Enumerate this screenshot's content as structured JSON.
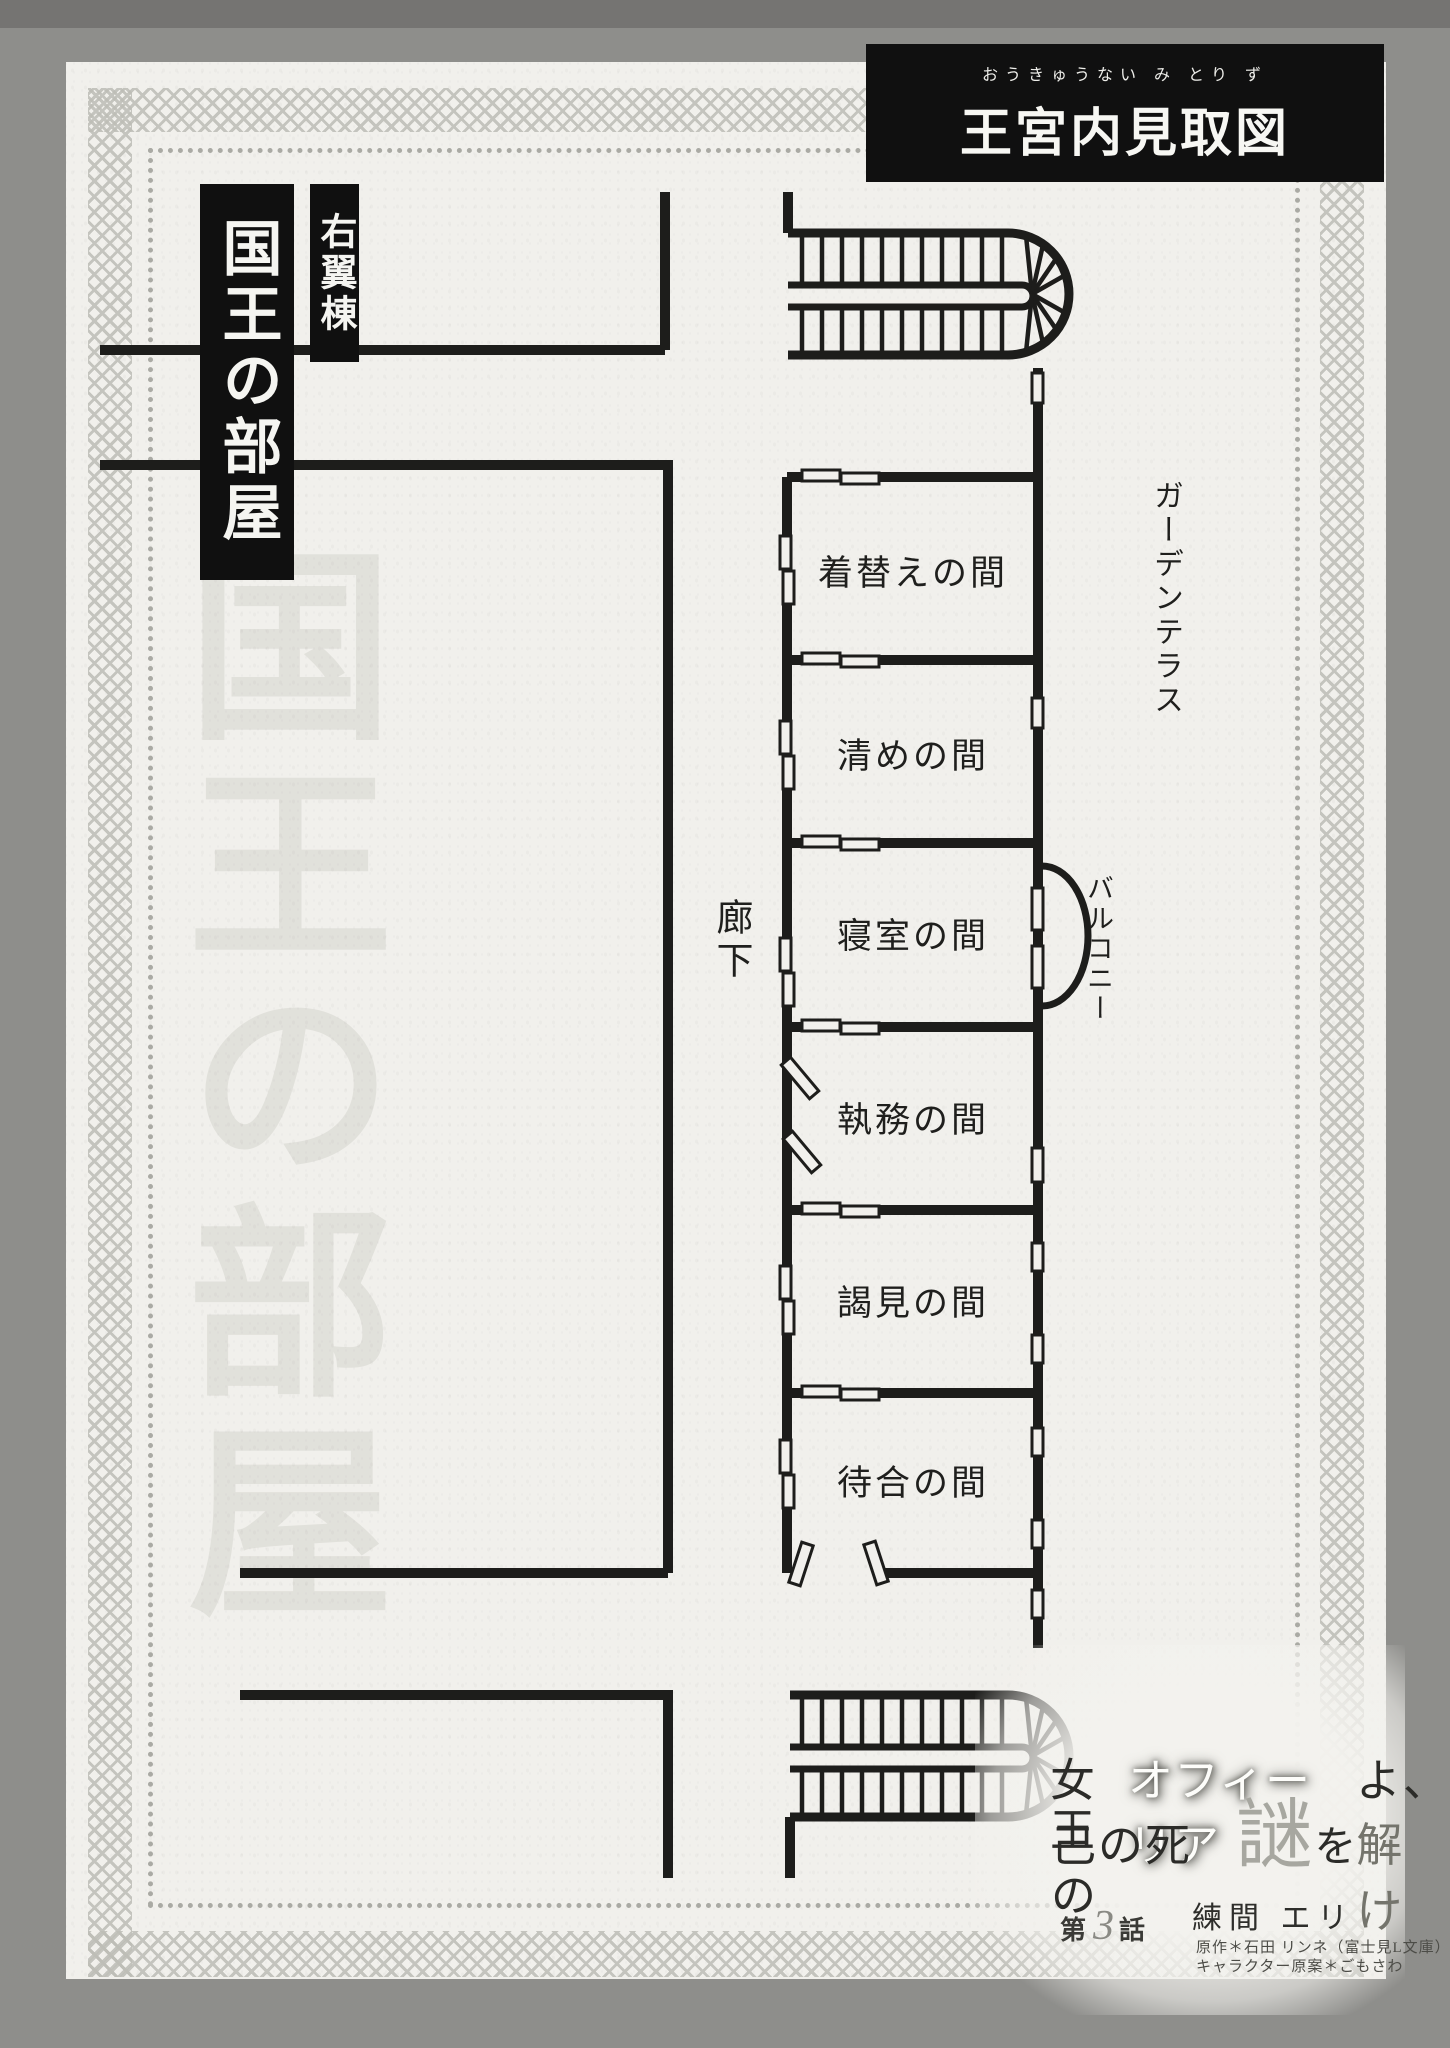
{
  "header": {
    "title": "王宮内見取図",
    "furigana": "おうきゅうない み とり ず"
  },
  "wing_label": "右翼棟",
  "section_label": "国王の部屋",
  "watermark": "国王の部屋",
  "rooms": [
    "着替えの間",
    "清めの間",
    "寝室の間",
    "執務の間",
    "謁見の間",
    "待合の間"
  ],
  "corridor_label": "廊下",
  "terrace_label": "ガーデンテラス",
  "balcony_label": "バルコニー",
  "footer": {
    "title_line1_prefix": "女王",
    "title_line1_name": "オフィーリア",
    "title_line1_suffix": "よ、",
    "title_line2_prefix": "己の死の",
    "title_line2_big": "謎",
    "title_line2_mid": "を",
    "title_line2_suffix": "解け",
    "author": "練間 エリ",
    "episode_prefix": "第",
    "episode_number": "3",
    "episode_suffix": "話",
    "credit1": "原作＊石田 リンネ（富士見L文庫）",
    "credit2": "キャラクター原案＊ごもさわ"
  }
}
